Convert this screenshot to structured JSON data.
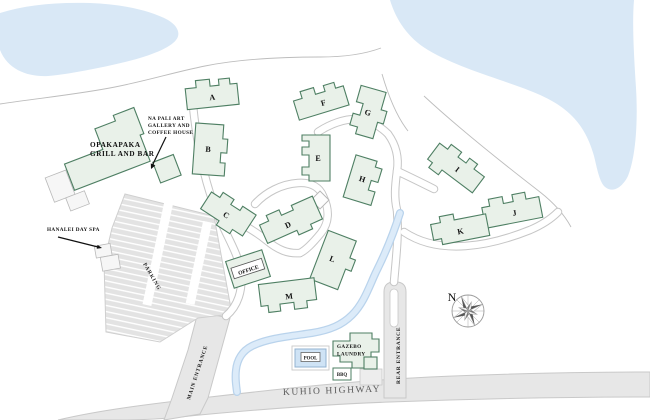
{
  "map": {
    "buildings": {
      "a": "A",
      "b": "B",
      "c": "C",
      "d": "D",
      "e": "E",
      "f": "F",
      "g": "G",
      "h": "H",
      "i": "I",
      "j": "J",
      "k": "K",
      "l": "L",
      "m": "M"
    },
    "places": {
      "grill_line1": "OPAKAPAKA",
      "grill_line2": "GRILL AND BAR",
      "gallery_line1": "NA PALI ART",
      "gallery_line2": "GALLERY AND",
      "gallery_line3": "COFFEE HOUSE",
      "spa": "HANALEI DAY SPA",
      "office": "OFFICE",
      "pool": "POOL",
      "gazebo": "GAZEBO",
      "laundry": "LAUNDRY",
      "bbq": "BBQ",
      "parking": "PARKING"
    },
    "roads": {
      "main_entrance": "MAIN ENTRANCE",
      "rear_entrance": "REAR ENTRANCE",
      "highway": "KUHIO HIGHWAY"
    },
    "compass": {
      "north": "N"
    },
    "colors": {
      "water": "#d9e8f6",
      "building_fill": "#e9f1e9",
      "building_stroke": "#4e7f63",
      "road_fill": "#e7e7e7",
      "road_edge": "#c9c9c9",
      "highway_text": "#5c5c5c",
      "pool_water": "#cfe3f5",
      "label_text": "#111111"
    }
  }
}
